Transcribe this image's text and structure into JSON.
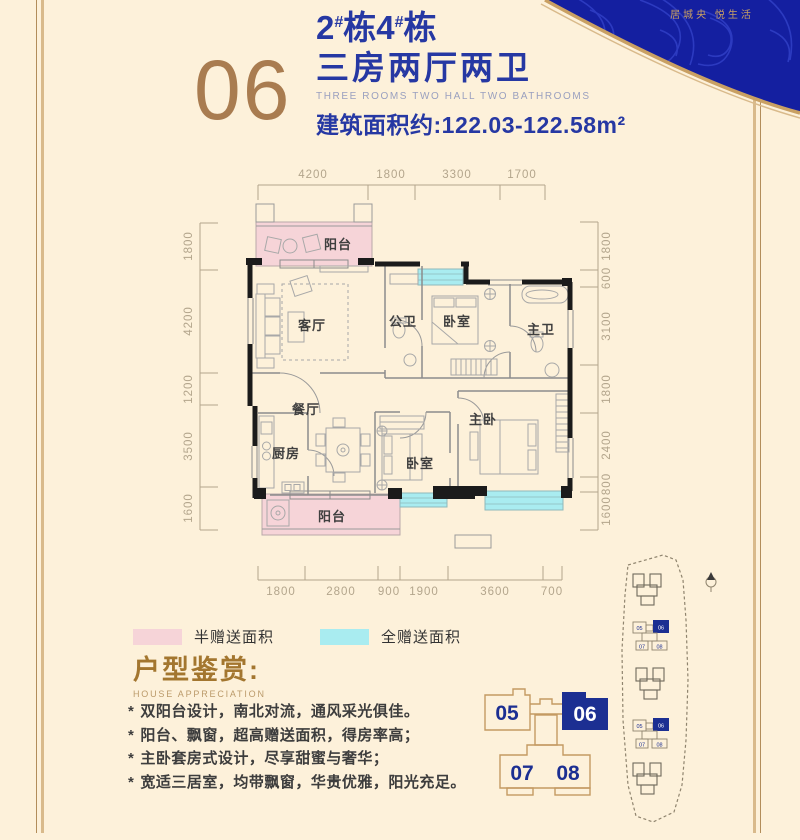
{
  "banner": {
    "tagline": "居城央 悦生活"
  },
  "header": {
    "unit_number": "06",
    "building_no_1": "2",
    "building_hash_1": "#",
    "building_dong_1": "栋",
    "building_no_2": "4",
    "building_hash_2": "#",
    "building_dong_2": "栋",
    "title_cn": "三房两厅两卫",
    "title_en": "THREE ROOMS TWO HALL TWO BATHROOMS",
    "area_label": "建筑面积约:",
    "area_value": "122.03-122.58m²"
  },
  "floorplan": {
    "dimensions_top": [
      "4200",
      "1800",
      "3300",
      "1700"
    ],
    "dimensions_left": [
      "1800",
      "4200",
      "1200",
      "3500",
      "1600"
    ],
    "dimensions_right": [
      "1800",
      "600",
      "3100",
      "1800",
      "2400",
      "800",
      "1600"
    ],
    "dimensions_bottom": [
      "1800",
      "2800",
      "900",
      "1900",
      "3600",
      "700"
    ],
    "rooms": [
      "阳台",
      "客厅",
      "公卫",
      "卧室",
      "主卫",
      "餐厅",
      "厨房",
      "卧室",
      "主卧",
      "阳台"
    ]
  },
  "legend": {
    "half": {
      "label": "半赠送面积",
      "color": "#f6d4d8"
    },
    "full": {
      "label": "全赠送面积",
      "color": "#a9ecf0"
    }
  },
  "appreciation": {
    "title": "户型鉴赏:",
    "subtitle": "HOUSE APPRECIATION",
    "marker": "*",
    "points": [
      "双阳台设计，南北对流，通风采光俱佳。",
      "阳台、飘窗，超高赠送面积，得房率高；",
      "主卧套房式设计，尽享甜蜜与奢华；",
      "宽适三居室，均带飘窗，华贵优雅，阳光充足。"
    ]
  },
  "unit_diagram": {
    "u05": "05",
    "u06": "06",
    "u07": "07",
    "u08": "08"
  },
  "colors": {
    "background": "#fdf1da",
    "navy": "#2638a3",
    "diagram_navy": "#1c2f92",
    "gold": "#c9a063",
    "unit_gold": "#a97c50",
    "pink": "#f6d4d8",
    "cyan": "#a9ecf0"
  }
}
